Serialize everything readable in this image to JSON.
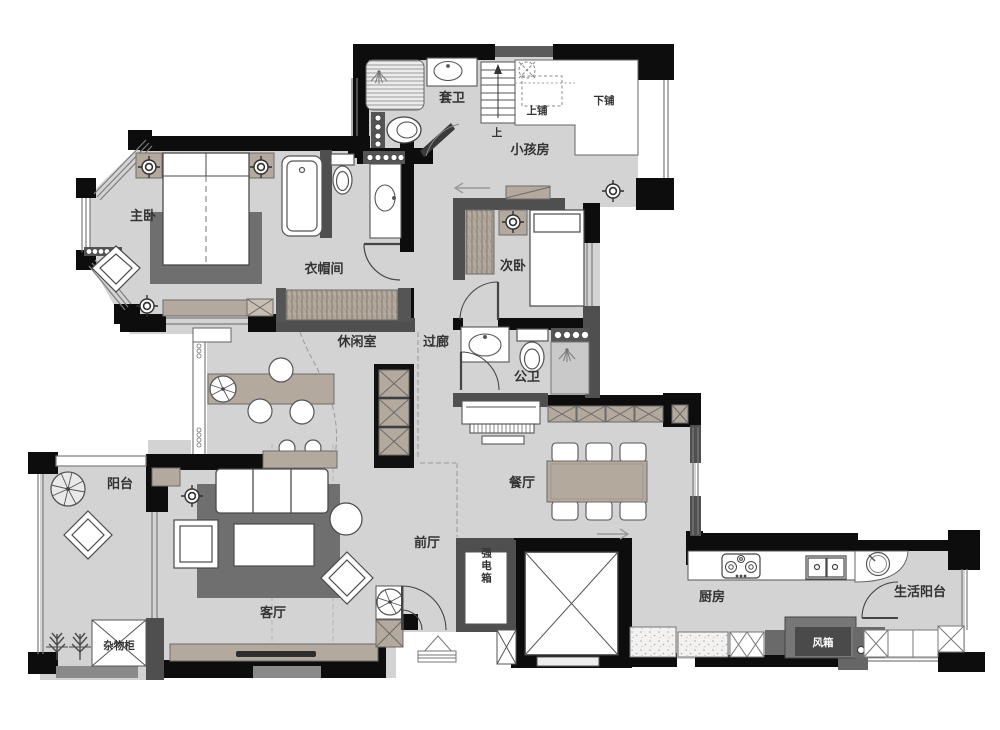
{
  "title": "apartment-floor-plan",
  "colors": {
    "wall_black": "#0d0d0d",
    "partition_gray": "#4f4f4f",
    "floor_gray": "#d3d3d3",
    "cabinet_beige": "#b3a99c",
    "rug_gray": "#6f6f6f",
    "label_text": "#333333"
  },
  "labels": {
    "ensuite_bath": "套卫",
    "kids_room": "小孩房",
    "upper_bunk": "上铺",
    "lower_bunk": "下铺",
    "up": "上",
    "master_bedroom": "主卧",
    "cloakroom": "衣帽间",
    "second_bedroom": "次卧",
    "lounge": "休闲室",
    "corridor": "过廊",
    "public_bath": "公卫",
    "dining_room": "餐厅",
    "foyer": "前厅",
    "power_box": "强电箱",
    "living_room": "客厅",
    "balcony": "阳台",
    "storage_cabinet": "杂物柜",
    "kitchen": "厨房",
    "utility_balcony": "生活阳台",
    "fan_box": "风箱"
  }
}
